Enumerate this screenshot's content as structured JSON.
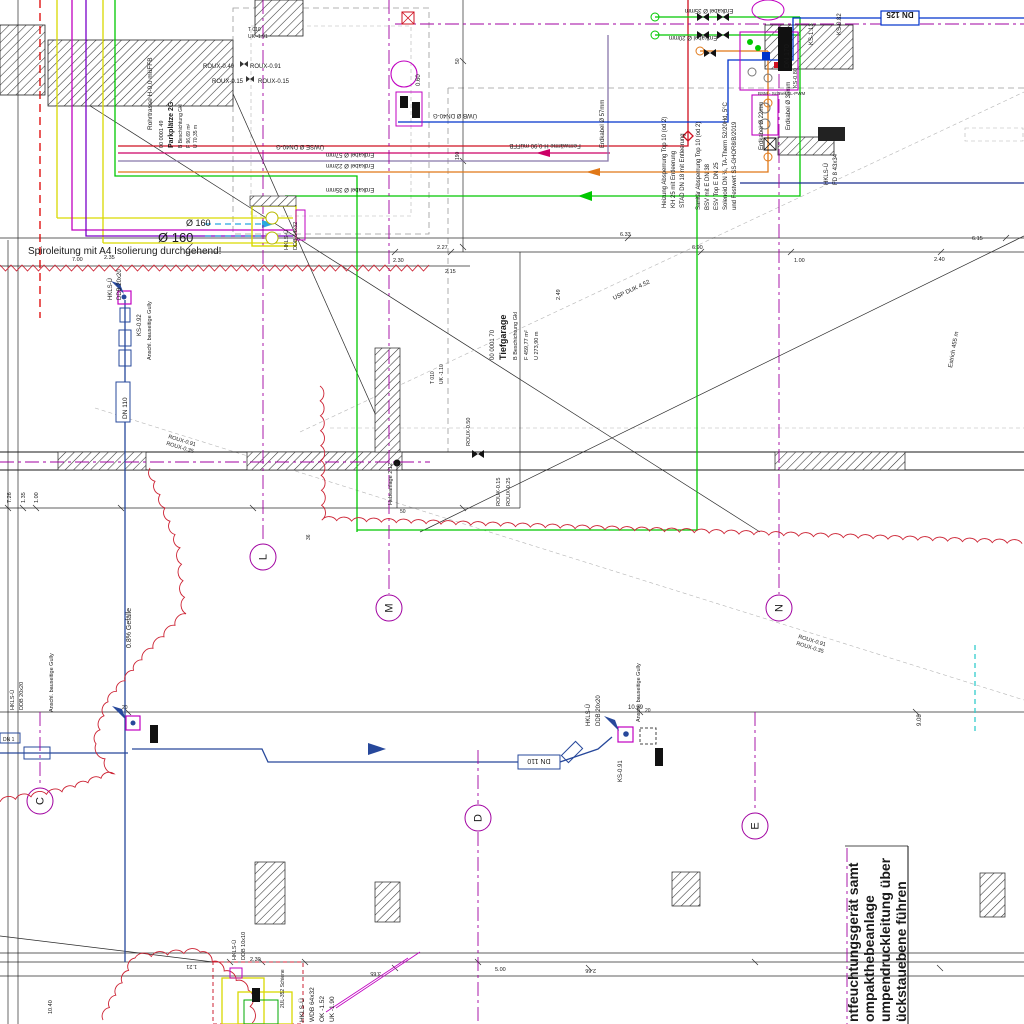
{
  "title": "Tiefgarage Installationsplan (HKLS)",
  "colors": {
    "cyan": "#29a8e0",
    "yellow": "#d9d900",
    "magenta": "#c000c0",
    "grid_magenta": "#a000a0",
    "purple": "#7a00c8",
    "red": "#cf1020",
    "green": "#00c800",
    "orange": "#e07818",
    "blue": "#0033cc",
    "navy": "#1a2f8f",
    "drain_blue": "#27489b",
    "gray": "#8a8a8a",
    "cloud_red": "#cc2233"
  },
  "notes": {
    "spiro": "Spiroleitung mit A4 Isolierung durchgehend!",
    "d160_small": "Ø 160",
    "d160_big": "Ø 160",
    "usp": "USP DUK 4.52",
    "estrich": "Estrich 455 m",
    "hebe": "Hebeanlage 2.12",
    "schiene": "2UL-352 Schiene",
    "gefaelle": "0.8% Gefälle"
  },
  "note_block": {
    "l1": "ntfeuchtungsgerät samt",
    "l2": "ompakthebeanlage",
    "l3": "umpendruckleitung über",
    "l4": "ückstauebene führen"
  },
  "stamps": {
    "garage": {
      "no": "00 0001 70",
      "name": "Tiefgarage",
      "finish": "B Beschichtung Gkl",
      "area": "F 459,77 m²",
      "perim": "U 273,90 m"
    },
    "parking": {
      "no": "00 0001 49",
      "name": "Parkplätze 2G",
      "finish": "B Beschichtung Gkl",
      "area": "F 96,69 m²",
      "perim": "U 70,35 m"
    }
  },
  "valves": {
    "heizung": [
      "Heizung Absperrung Top 10 (od 2)",
      "KH 25 mit Entleerung",
      "STAD DN 18 mit Entleerung"
    ],
    "sanitaer": [
      "Sanitär Absperrung Top 10 (od 2)",
      "BSV mit E DN 38",
      "ESV Top E DN 25",
      "Solenoid DN ¼, TA-Therm 52/20Hd, 5°C",
      "und Festwert SS-GHOR8/B/2019"
    ]
  },
  "pipes": {
    "uwb": "ÜWB Ø DN40-G",
    "uwse": "ÜWSE Ø DN40-G",
    "kabel57": "Erdkabel Ø 57mm",
    "kabel22": "Erdkabel Ø 22mm",
    "kabel35": "Erdkabel Ø 35mm",
    "kabel20": "Erdkabel Ø 20mm",
    "fern": "Fernwärme H-0,90 müFFB",
    "rohr": "Rohrtrasse H-0,0 müFFB"
  },
  "ids": {
    "ks082": "KS-0.82",
    "ks113": "KS-1.13",
    "ks080": "KS-0.80",
    "ks092": "KS-0.92",
    "ks091": "KS-0.91",
    "bsm": "BSM - Schnell LL-PWM",
    "dn125": "DN 125",
    "dn170": "DN 170",
    "dn110": "DN 110",
    "dnleft": "DN 1",
    "roux040": "ROUX-0.40",
    "roux091": "ROUX-0.91",
    "roux015": "ROUX-0.15",
    "roux015b": "ROUX-0.15",
    "roux025": "ROUX-0.25",
    "roux050": "ROUX-0.50",
    "rouxd1": "ROUX-0.91",
    "rouxd2": "ROUX-0.35",
    "hkls": "HKLS-Ü",
    "ddb64": "DDB 64x32",
    "ddb20": "DDB 20x20",
    "ddb10": "DDB 10x10",
    "fd8": "FD 8 43x34",
    "wdb": "WDB 64x32",
    "ok": "OK -1.52",
    "uk": "UK -1.90",
    "gully": "Anschl. bauseitige Gully",
    "t010": "T 010",
    "uk191": "UK -1.91",
    "uk110": "UK -1.10",
    "p060": "0.60"
  },
  "grid": {
    "l": "L",
    "m": "M",
    "n": "N",
    "c": "C",
    "d": "D",
    "e": "E"
  },
  "dims": {
    "t227": "2.27",
    "t230": "2.30",
    "t215": "2.15",
    "t633": "6.33",
    "t690": "6.90",
    "t615": "6.15",
    "t240": "2.40",
    "t100": "1.00",
    "t700": "7.00",
    "t235": "2.35",
    "t249": "2.49",
    "v726": "7.26",
    "v135": "1.35",
    "v100": "1.00",
    "h50": "50",
    "v190": "190",
    "n36": "36",
    "b1039": "10.39",
    "b908": "9.08",
    "b20": "20",
    "b500": "5.00",
    "b266": "2.66",
    "b121": "1.21",
    "b230": "2.30",
    "b365": "3.65",
    "b1040": "10.40"
  }
}
